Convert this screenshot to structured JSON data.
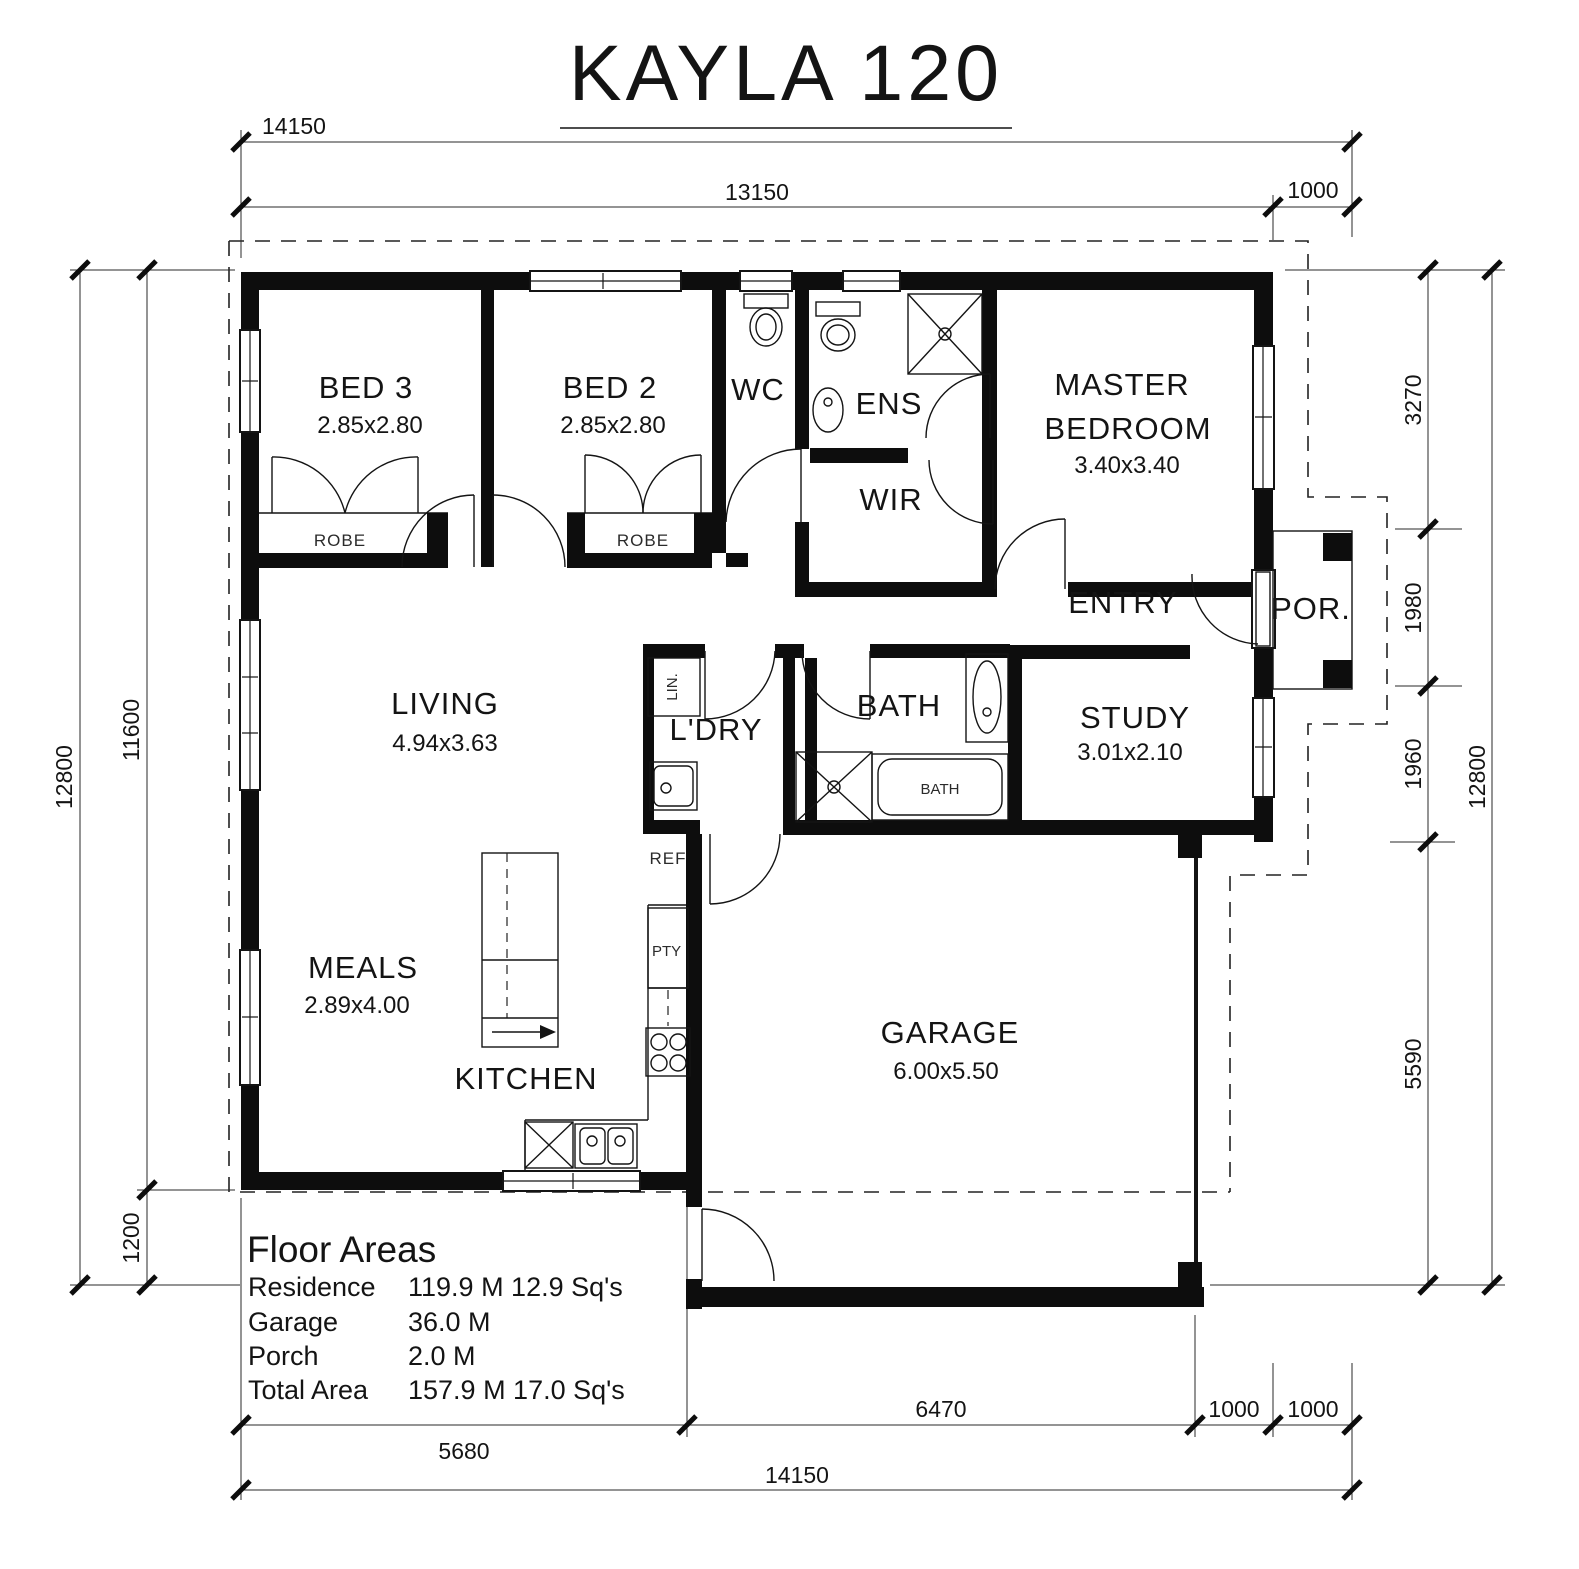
{
  "title": {
    "text": "KAYLA 120"
  },
  "rooms": {
    "bed3": {
      "name": "BED 3",
      "size": "2.85x2.80"
    },
    "bed2": {
      "name": "BED 2",
      "size": "2.85x2.80"
    },
    "master": {
      "name1": "MASTER",
      "name2": "BEDROOM",
      "size": "3.40x3.40"
    },
    "living": {
      "name": "LIVING",
      "size": "4.94x3.63"
    },
    "meals": {
      "name": "MEALS",
      "size": "2.89x4.00"
    },
    "study": {
      "name": "STUDY",
      "size": "3.01x2.10"
    },
    "garage": {
      "name": "GARAGE",
      "size": "6.00x5.50"
    },
    "kitchen": {
      "name": "KITCHEN"
    },
    "wc": {
      "name": "WC"
    },
    "ens": {
      "name": "ENS"
    },
    "wir": {
      "name": "WIR"
    },
    "entry": {
      "name": "ENTRY"
    },
    "porch": {
      "name": "POR."
    },
    "ldry": {
      "name": "L'DRY"
    },
    "bath": {
      "name": "BATH"
    }
  },
  "fixtures": {
    "robe3": "ROBE",
    "robe2": "ROBE",
    "lin": "LIN.",
    "ref": "REF",
    "pty": "PTY",
    "bath_tub": "BATH"
  },
  "dimensions": {
    "top_total": "14150",
    "top_main": "13150",
    "top_porch": "1000",
    "left_total": "12800",
    "left_upper": "11600",
    "left_lower": "1200",
    "right_seg1": "3270",
    "right_seg2": "1980",
    "right_seg3": "1960",
    "right_seg4": "5590",
    "right_total": "12800",
    "bottom_seg1": "5680",
    "bottom_seg2": "6470",
    "bottom_seg3": "1000",
    "bottom_seg4": "1000",
    "bottom_total": "14150"
  },
  "floor_areas": {
    "heading": "Floor Areas",
    "rows": [
      {
        "label": "Residence",
        "value": "119.9 M 12.9 Sq's"
      },
      {
        "label": "Garage",
        "value": "36.0 M"
      },
      {
        "label": "Porch",
        "value": "2.0 M"
      },
      {
        "label": "Total Area",
        "value": "157.9 M 17.0 Sq's"
      }
    ]
  },
  "colors": {
    "ink": "#141414",
    "paper": "#ffffff"
  }
}
